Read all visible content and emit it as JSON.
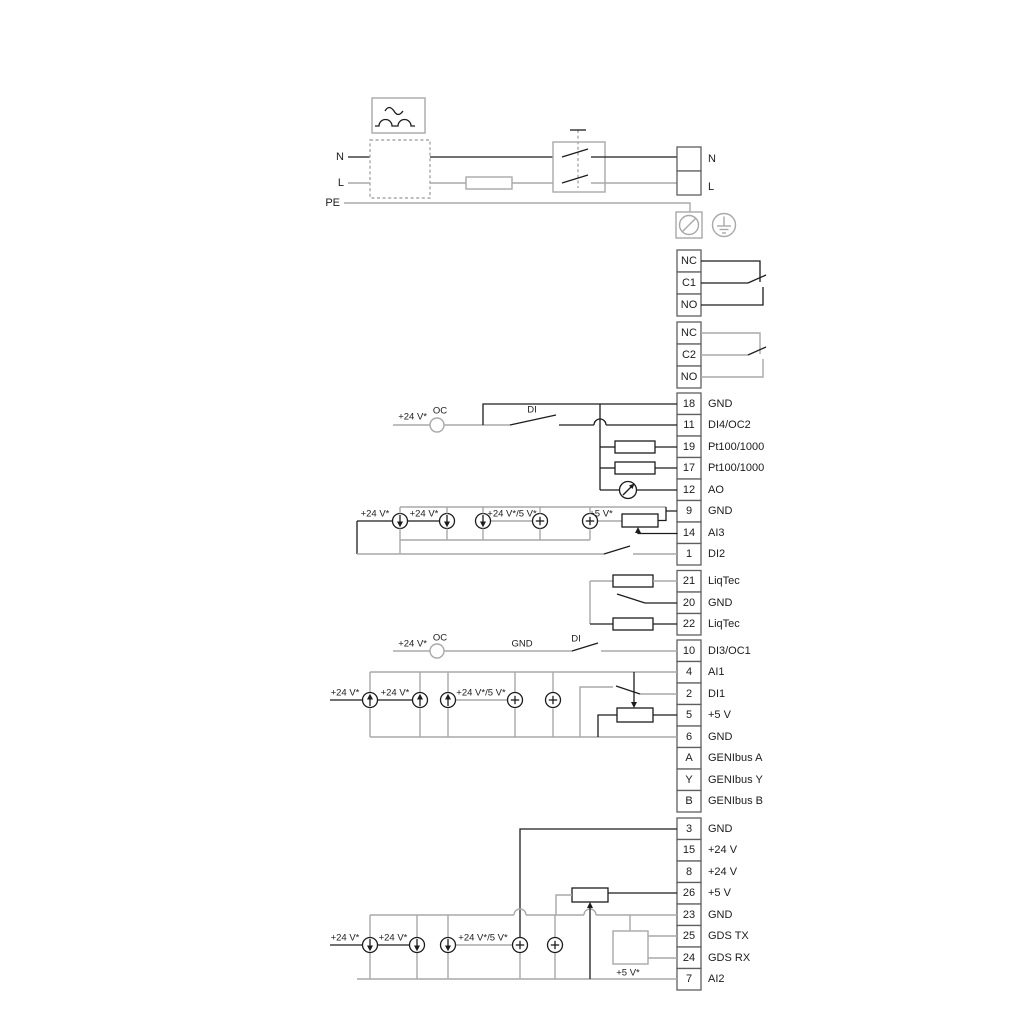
{
  "power": {
    "left_n": "N",
    "left_l": "L",
    "left_pe": "PE",
    "right_n": "N",
    "right_l": "L"
  },
  "relay1": {
    "nc": "NC",
    "c": "C1",
    "no": "NO"
  },
  "relay2": {
    "nc": "NC",
    "c": "C2",
    "no": "NO"
  },
  "group1": {
    "terminals": [
      {
        "num": "18",
        "label": "GND"
      },
      {
        "num": "11",
        "label": "DI4/OC2"
      },
      {
        "num": "19",
        "label": "Pt100/1000"
      },
      {
        "num": "17",
        "label": "Pt100/1000"
      },
      {
        "num": "12",
        "label": "AO"
      },
      {
        "num": "9",
        "label": "GND"
      },
      {
        "num": "14",
        "label": "AI3"
      },
      {
        "num": "1",
        "label": "DI2"
      }
    ]
  },
  "liqtec": {
    "terminals": [
      {
        "num": "21",
        "label": "LiqTec"
      },
      {
        "num": "20",
        "label": "GND"
      },
      {
        "num": "22",
        "label": "LiqTec"
      }
    ]
  },
  "group2": {
    "terminals": [
      {
        "num": "10",
        "label": "DI3/OC1"
      },
      {
        "num": "4",
        "label": "AI1"
      },
      {
        "num": "2",
        "label": "DI1"
      },
      {
        "num": "5",
        "label": "+5 V"
      },
      {
        "num": "6",
        "label": "GND"
      },
      {
        "num": "A",
        "label": "GENIbus A"
      },
      {
        "num": "Y",
        "label": "GENIbus Y"
      },
      {
        "num": "B",
        "label": "GENIbus B"
      }
    ]
  },
  "group3": {
    "terminals": [
      {
        "num": "3",
        "label": "GND"
      },
      {
        "num": "15",
        "label": "+24 V"
      },
      {
        "num": "8",
        "label": "+24 V"
      },
      {
        "num": "26",
        "label": "+5 V"
      },
      {
        "num": "23",
        "label": "GND"
      },
      {
        "num": "25",
        "label": "GDS TX"
      },
      {
        "num": "24",
        "label": "GDS RX"
      },
      {
        "num": "7",
        "label": "AI2"
      }
    ]
  },
  "ann": {
    "v24": "+24 V*",
    "v24v5": "+24 V*/5 V*",
    "v5": "+5 V*",
    "oc": "OC",
    "di": "DI",
    "gnd": "GND"
  },
  "colors": {
    "wire_black": "#1c1c1c",
    "wire_gray": "#a9a9a9",
    "terminal_border": "#5f5f5f"
  }
}
